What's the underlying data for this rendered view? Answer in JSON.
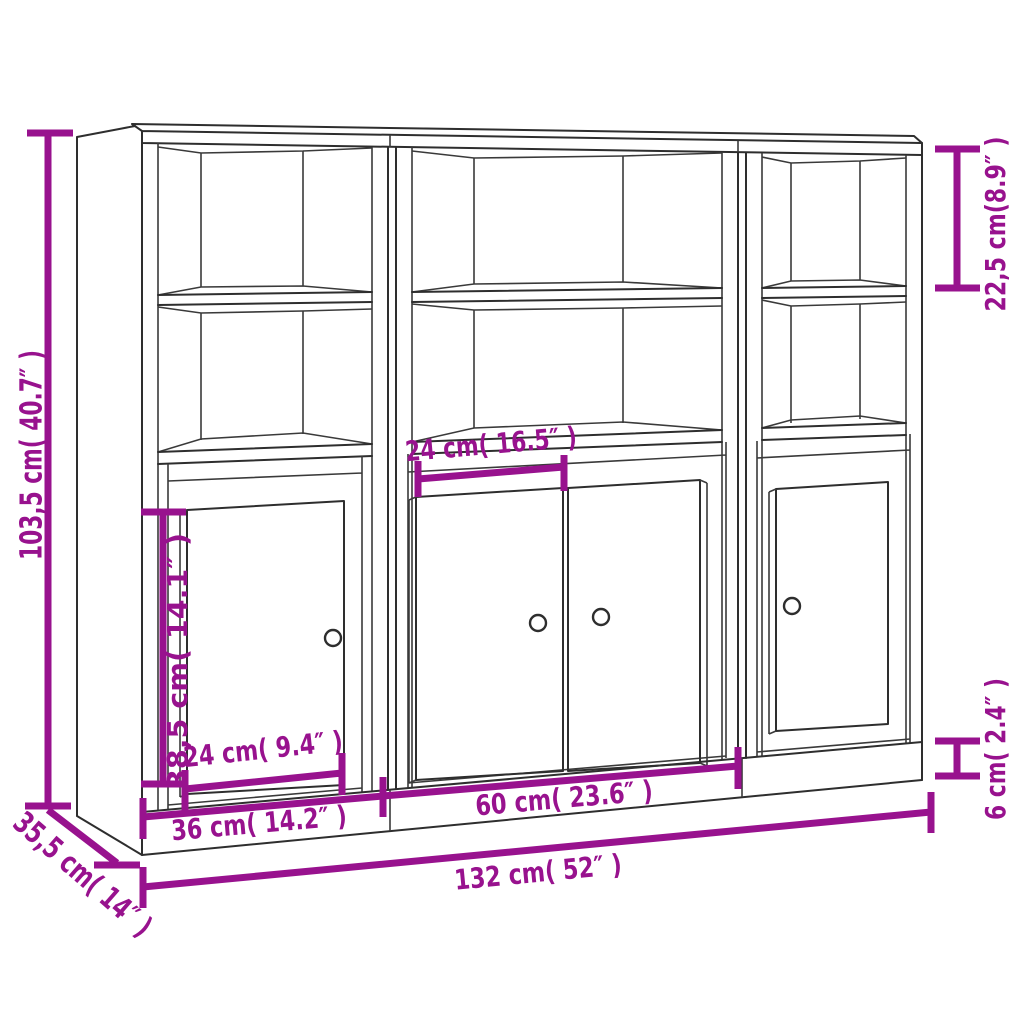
{
  "figure": {
    "type": "product-dimension-diagram",
    "subject": "3-section highboard sideboard line drawing",
    "background": "#ffffff",
    "line_color": "#2e2e2e",
    "dimension_color": "#98128E"
  },
  "dimensions": {
    "height": "103,5 cm( 40.7″ )",
    "top_compartment_height": "22,5 cm(8.9″ )",
    "plinth_height": "6 cm( 2.4″ )",
    "middle_clearance_width": "24 cm( 16.5″ )",
    "door_height": "38,5 cm( 14.1″ )",
    "left_door_width": "24 cm( 9.4″ )",
    "left_unit_width": "36 cm( 14.2″ )",
    "middle_unit_width": "60 cm( 23.6″ )",
    "total_width": "132 cm( 52″ )",
    "depth": "35,5 cm( 14″ )"
  }
}
